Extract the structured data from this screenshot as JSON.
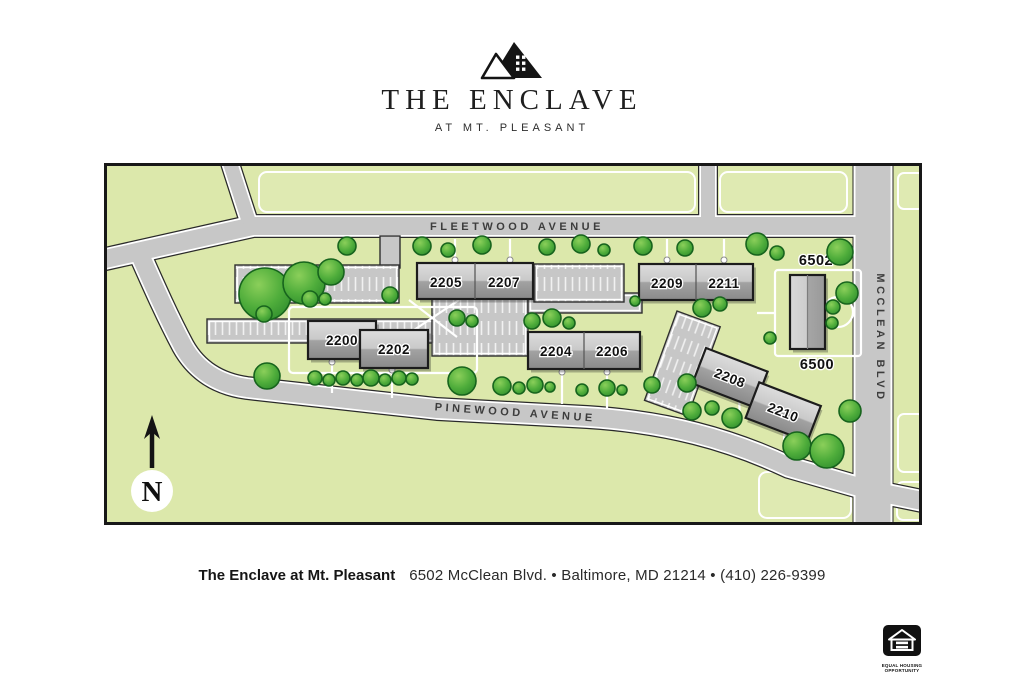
{
  "logo": {
    "title": "THE ENCLAVE",
    "subtitle": "AT MT. PLEASANT"
  },
  "map": {
    "streets": {
      "fleetwood": "FLEETWOOD AVENUE",
      "pinewood": "PINEWOOD AVENUE",
      "mcclean": "MCCLEAN BLVD"
    },
    "units": {
      "u2200": "2200",
      "u2202": "2202",
      "u2204": "2204",
      "u2205": "2205",
      "u2206": "2206",
      "u2207": "2207",
      "u2208": "2208",
      "u2209": "2209",
      "u2210": "2210",
      "u2211": "2211",
      "u6500": "6500",
      "u6502": "6502"
    },
    "compass": {
      "north": "N"
    }
  },
  "footer": {
    "name": "The Enclave at Mt. Pleasant",
    "address": "6502 McClean Blvd. • Baltimore, MD 21214 • (410) 226-9399"
  },
  "equal_housing": {
    "line1": "EQUAL HOUSING",
    "line2": "OPPORTUNITY"
  },
  "colors": {
    "grass": "#dce8ab",
    "road": "#c7c7c7",
    "building_light": "#d6d6d6",
    "building_dark": "#8c8c8c",
    "tree": "#4fad3b",
    "outline": "#1c1c1c"
  }
}
